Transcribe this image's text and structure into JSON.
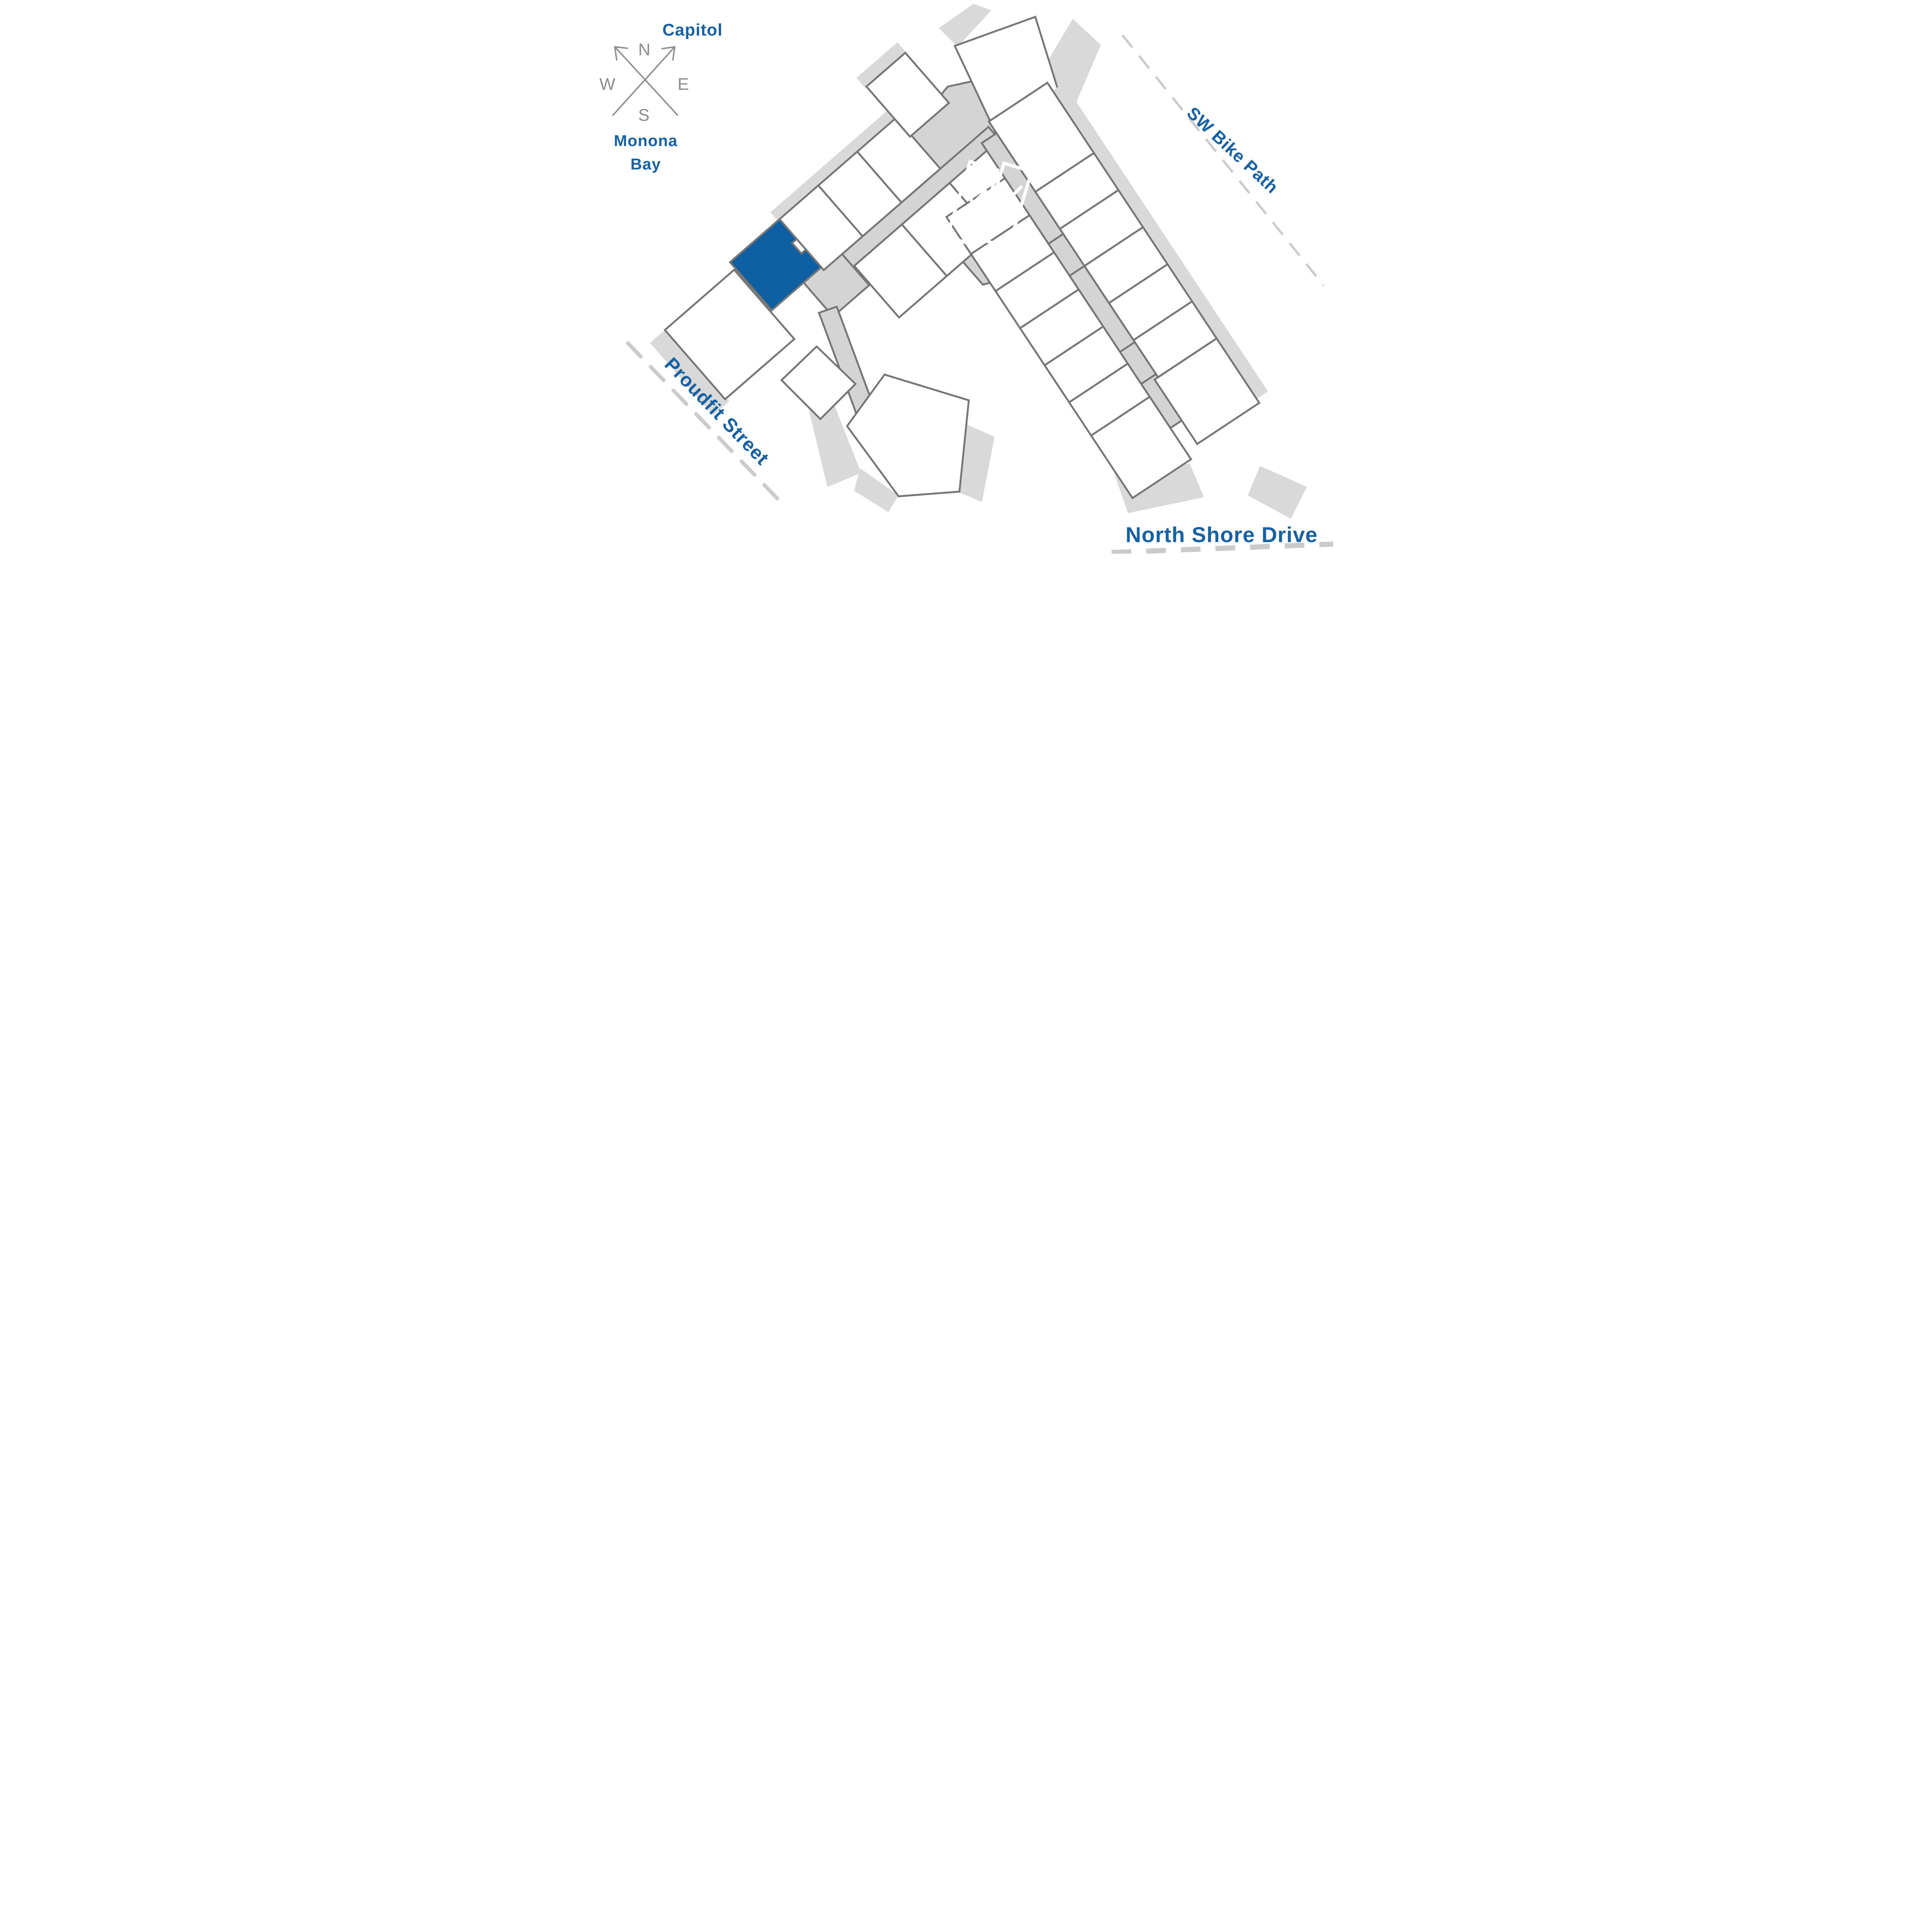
{
  "compass": {
    "north": "N",
    "east": "E",
    "south": "S",
    "west": "W"
  },
  "labels": {
    "capitol": "Capitol",
    "monona_line1": "Monona",
    "monona_line2": "Bay",
    "bike_path": "SW Bike Path",
    "proudfit": "Proudfit Street",
    "north_shore": "North Shore Drive"
  },
  "colors": {
    "label_blue": "#1761A2",
    "unit_highlight": "#0E5FA1",
    "outline": "#767676",
    "corridor": "#D4D4D4",
    "balcony": "#D9D9D9",
    "street_dash": "#CBCBCB",
    "compass_gray": "#8C8C8C"
  }
}
